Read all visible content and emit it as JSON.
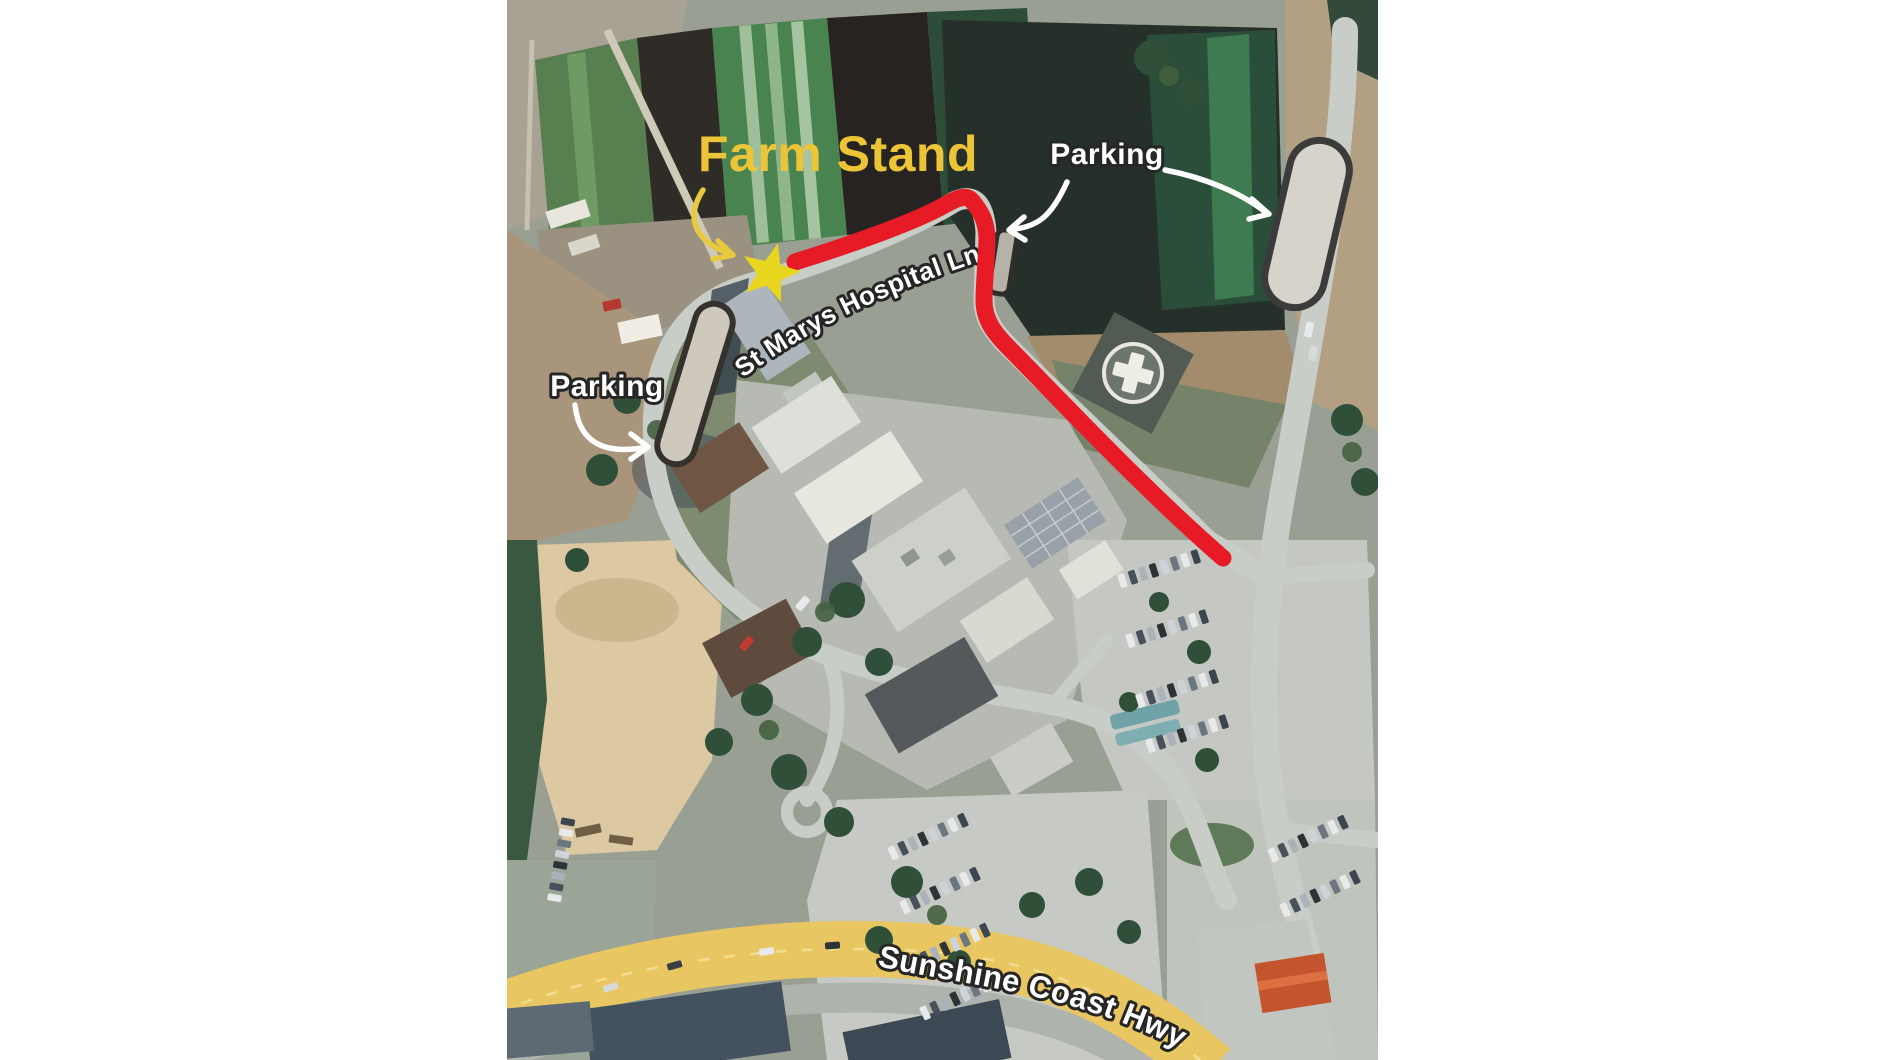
{
  "canvas": {
    "width": 1885,
    "height": 1060,
    "background": "#ffffff"
  },
  "map": {
    "annotations": {
      "farm_stand": {
        "label": "Farm Stand",
        "color": "#ECC437",
        "arrow_color": "#E9C93F"
      },
      "parking_top_right": {
        "label": "Parking"
      },
      "parking_left": {
        "label": "Parking"
      },
      "arrow_color": "#FFFFFF"
    },
    "roads": {
      "st_marys": {
        "label": "St Marys Hospital Ln"
      },
      "sunshine": {
        "label": "Sunshine Coast Hwy"
      }
    },
    "route": {
      "color": "#E61B25"
    },
    "star": {
      "color": "#E7D51E"
    },
    "highway": {
      "color": "#E8C661"
    },
    "parking_strip": {
      "fill": "#D6D3CA",
      "outline": "#3B3B3B"
    }
  }
}
